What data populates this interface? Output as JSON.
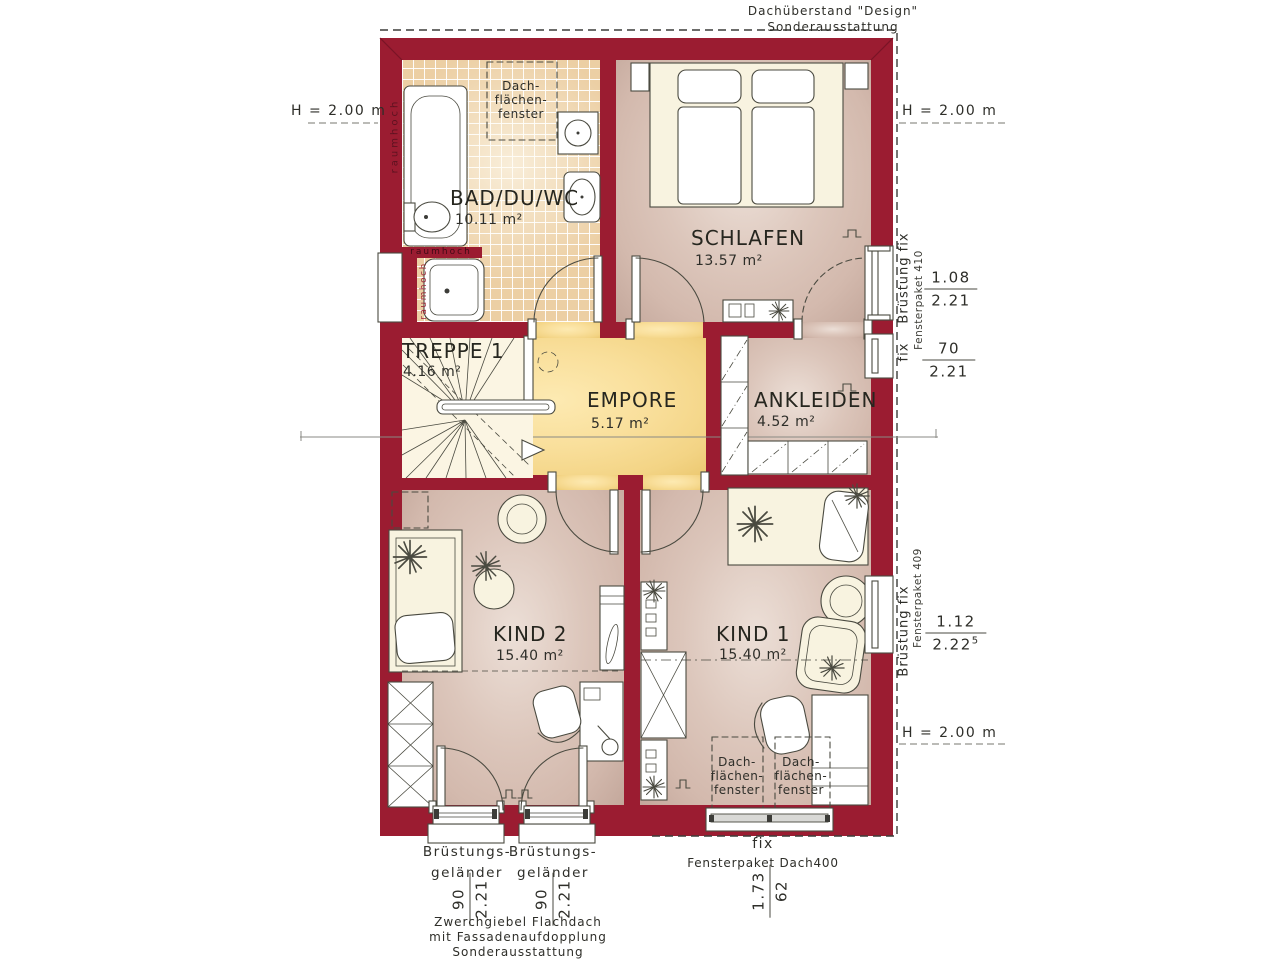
{
  "plan": {
    "title_note": "Dachüberstand \"Design\"\nSonderausstattung",
    "gable_note": "Zwerchgiebel Flachdach\nmit Fassadenaufdopplung\nSonderausstattung",
    "height_left": "H = 2.00 m",
    "height_right_top": "H = 2.00 m",
    "height_right_bottom": "H = 2.00 m",
    "skylight": "Dach-\nflächen-\nfenster",
    "raumhoch": "raumhoch",
    "rooms": [
      {
        "name": "BAD/DU/WC",
        "area": "10.11 m²"
      },
      {
        "name": "SCHLAFEN",
        "area": "13.57 m²"
      },
      {
        "name": "TREPPE 1",
        "area": "4.16 m²"
      },
      {
        "name": "EMPORE",
        "area": "5.17 m²"
      },
      {
        "name": "ANKLEIDEN",
        "area": "4.52 m²"
      },
      {
        "name": "KIND 2",
        "area": "15.40 m²"
      },
      {
        "name": "KIND 1",
        "area": "15.40 m²"
      }
    ],
    "win_right_top": {
      "label": "Brüstung fix",
      "package": "Fensterpaket 410",
      "w": "1.08",
      "h": "2.21"
    },
    "win_right_mid": {
      "label": "fix",
      "w": "70",
      "h": "2.21"
    },
    "win_right_kind1": {
      "label": "Brüstung fix",
      "package": "Fensterpaket 409",
      "w": "1.12",
      "h": "2.22",
      "sup": "5"
    },
    "win_balcony": {
      "label": "Brüstungs-\ngeländer",
      "w": "90",
      "h": "2.21"
    },
    "win_roof": {
      "label": "fix",
      "package": "Fensterpaket Dach400",
      "w": "1.73",
      "h": "62"
    },
    "colors": {
      "wall": "#9b1c31",
      "line": "#4a4a40",
      "tile": "#eccfa4",
      "floor_mauve": "#d3b9ad",
      "floor_mauve_light": "#ecdfd7",
      "floor_yellow": "#f3d485",
      "floor_yellow_light": "#fdeab2",
      "text": "#2e2e29"
    }
  }
}
